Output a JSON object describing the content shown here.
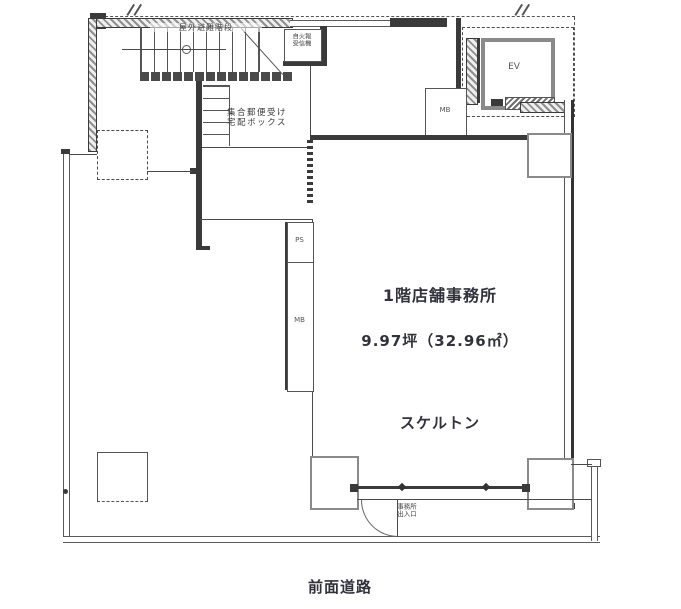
{
  "plan": {
    "labels": {
      "stairs": "屋外避難階段",
      "fire_alarm_line1": "自火報",
      "fire_alarm_line2": "受信機",
      "mailbox_line1": "集合郵便受け",
      "mailbox_line2": "宅配ボックス",
      "elevator": "EV",
      "meter_box_upper": "MB",
      "pipe_space": "PS",
      "meter_box_lower": "MB",
      "unit_title": "1階店舗事務所",
      "unit_area": "9.97坪（32.96㎡）",
      "unit_condition": "スケルトン",
      "entrance_line1": "事務所",
      "entrance_line2": "出入口",
      "front_road": "前面道路"
    },
    "colors": {
      "line": "#4a4a4a",
      "wall_dark": "#3a3a3a",
      "wall_gray": "#8a8a8a",
      "text_dark": "#32323c",
      "background": "#ffffff"
    }
  }
}
